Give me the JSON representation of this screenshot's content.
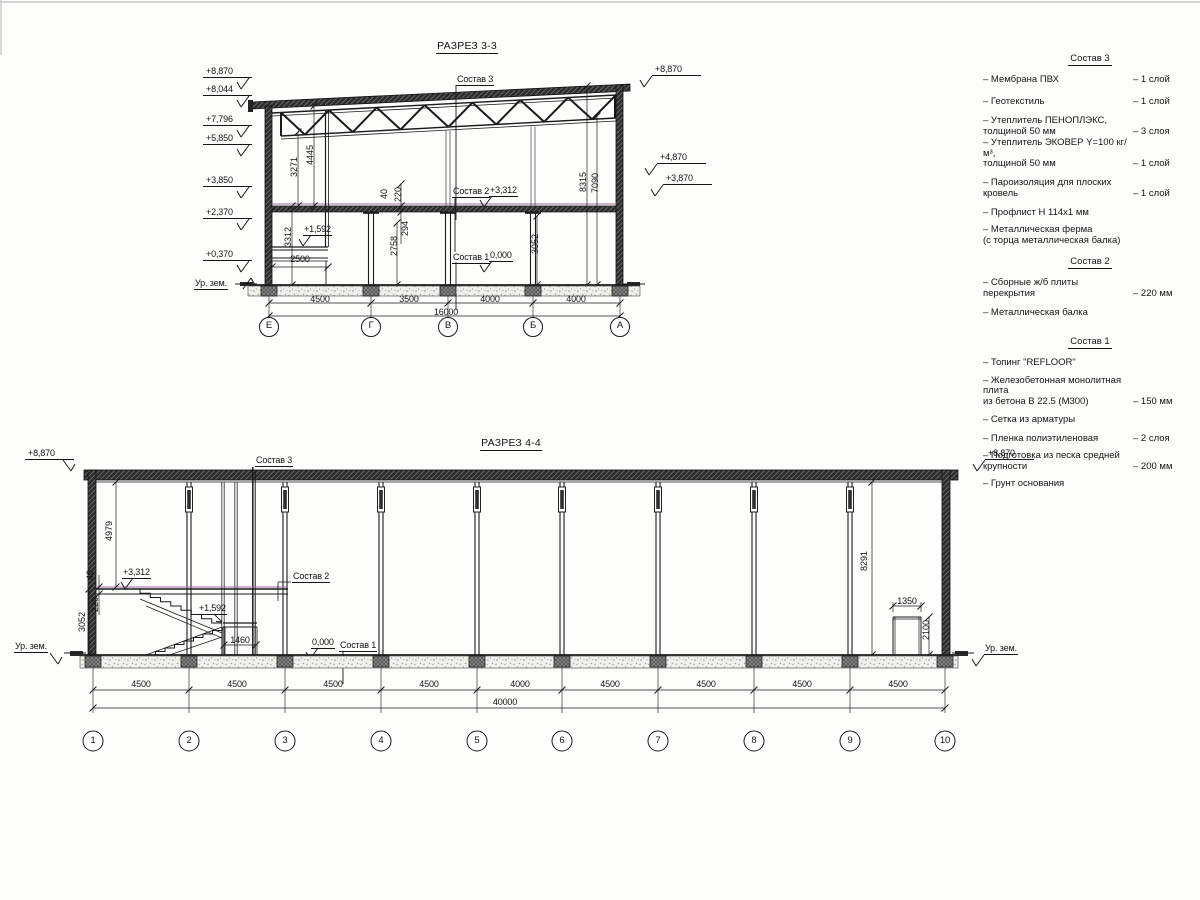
{
  "section33": {
    "title": "РАЗРЕЗ 3-3",
    "levels_left": [
      "+8,870",
      "+8,044",
      "+7,796",
      "+5,850",
      "+3,850",
      "+2,370",
      "+0,370"
    ],
    "ground_left": "Ур. зем.",
    "levels_right": [
      "+8,870",
      "+4,870",
      "+3,870"
    ],
    "callouts": {
      "sostav3": "Состав 3",
      "sostav2": "Состав 2",
      "sostav1": "Состав 1",
      "level_3312": "+3,312",
      "level_1592": "+1,592",
      "level_0": "0,000"
    },
    "dims": {
      "v3271": "3271",
      "v4445": "4445",
      "v3312": "3312",
      "v40": "40",
      "v220": "220",
      "v294": "294",
      "v2758": "2758",
      "v3052": "3052",
      "v8315": "8315",
      "v7090": "7090",
      "h2500": "2500"
    },
    "dims_bottom": [
      "4500",
      "3500",
      "4000",
      "4000"
    ],
    "dim_total": "16000",
    "grids": [
      "Е",
      "Г",
      "В",
      "Б",
      "А"
    ]
  },
  "section44": {
    "title": "РАЗРЕЗ 4-4",
    "level_top_left": "+8,870",
    "level_top_right": "+8,870",
    "ground_left": "Ур. зем.",
    "ground_right": "Ур. зем.",
    "callouts": {
      "sostav3": "Состав 3",
      "sostav2": "Состав 2",
      "sostav1": "Состав 1",
      "level_3312": "+3,312",
      "level_1592": "+1,592",
      "level_0": "0,000"
    },
    "dims": {
      "v4979": "4979",
      "v40": "40",
      "v220": "220",
      "v3052": "3052",
      "h1460": "1460",
      "v8291": "8291",
      "h1350": "1350",
      "v2100": "2100"
    },
    "dims_bottom": [
      "4500",
      "4500",
      "4500",
      "4500",
      "4000",
      "4500",
      "4500",
      "4500",
      "4500"
    ],
    "dim_total": "40000",
    "grids": [
      "1",
      "2",
      "3",
      "4",
      "5",
      "6",
      "7",
      "8",
      "9",
      "10"
    ]
  },
  "legend": {
    "compositions": [
      {
        "heading": "Состав 3",
        "items": [
          {
            "label": "– Мембрана ПВХ",
            "value": "– 1 слой"
          },
          {
            "label": "– Геотекстиль",
            "value": "– 1 слой"
          },
          {
            "label": "– Утеплитель ПЕНОПЛЭКС,\nтолщиной 50 мм",
            "value": "– 3 слоя"
          },
          {
            "label": "– Утеплитель ЭКОВЕР Y=100 кг/м³,\nтолщиной 50 мм",
            "value": "– 1 слой"
          },
          {
            "label": "– Пароизоляция для плоских кровель",
            "value": "– 1 слой"
          },
          {
            "label": "– Профлист Н 114х1 мм",
            "value": ""
          },
          {
            "label": "– Металлическая ферма\n(с торца металлическая балка)",
            "value": ""
          }
        ]
      },
      {
        "heading": "Состав 2",
        "items": [
          {
            "label": "– Сборные ж/б плиты перекрытия",
            "value": "– 220 мм"
          },
          {
            "label": "– Металлическая балка",
            "value": ""
          }
        ]
      },
      {
        "heading": "Состав 1",
        "items": [
          {
            "label": "– Топинг \"REFLOOR\"",
            "value": ""
          },
          {
            "label": "– Железобетонная  монолитная плита\nиз бетона В 22.5 (М300)",
            "value": "– 150 мм"
          },
          {
            "label": "– Сетка из арматуры",
            "value": ""
          },
          {
            "label": "– Пленка полиэтиленовая",
            "value": "– 2 слоя"
          },
          {
            "label": "– Подготовка из песка средней\nкрупности",
            "value": "– 200 мм"
          },
          {
            "label": "– Грунт основания",
            "value": ""
          }
        ]
      }
    ]
  }
}
